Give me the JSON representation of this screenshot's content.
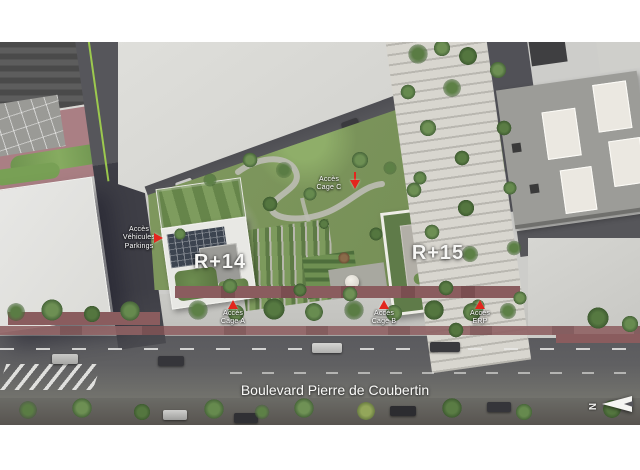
{
  "annotations": {
    "building_left_label": "R+14",
    "building_right_label": "R+15",
    "access_vehicles_label": "Accès\nVéhicules\nParkings",
    "access_cage_a_label": "Accès\nCage A",
    "access_cage_b_label": "Accès\nCage B",
    "access_cage_c_label": "Accès\nCage C",
    "access_erp_label": "Accès\nERP",
    "street_label": "Boulevard Pierre de Coubertin",
    "compass_north_label": "N"
  },
  "colors": {
    "annotation_arrow": "#e3261d",
    "label_text": "#ffffff",
    "asphalt_road": "#55555a",
    "plaza_concrete": "#d6d6d2",
    "lawn_green": "#7d9a5d",
    "tree_green": "#4e6e3c",
    "planting_strip_red": "#8a5c5e",
    "solar_panel_dark": "#3c4450",
    "gravel_roof": "#b2afa7",
    "page_background": "#ffffff"
  }
}
